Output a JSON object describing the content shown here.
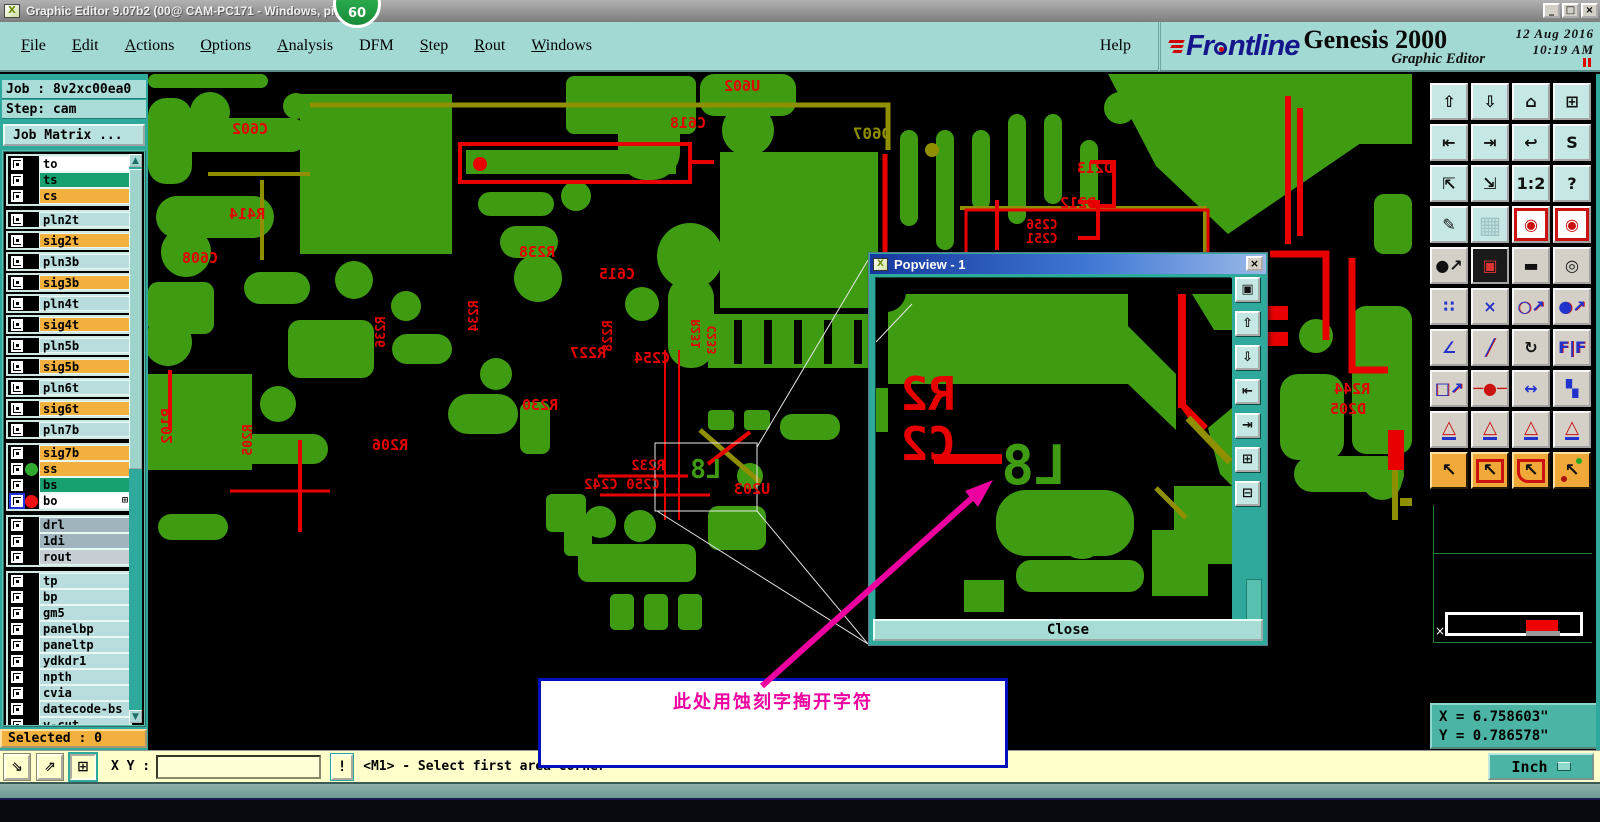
{
  "colors": {
    "red": "#e80000",
    "green": "#3f9b12",
    "olive": "#8f8f00",
    "teal": "#2fa99b",
    "orange": "#f2b13e",
    "magenta": "#ee00a0",
    "popview_blue": "#2858c8"
  },
  "window": {
    "title": "Graphic Editor 9.07b2 (00@   CAM-PC171 - Windows, pid:5572)",
    "badge": "60",
    "minimize": "_",
    "maximize": "□",
    "close": "×",
    "icon_glyph": "X"
  },
  "menu": {
    "items": [
      {
        "label": "File",
        "u": 1
      },
      {
        "label": "Edit",
        "u": 1
      },
      {
        "label": "Actions",
        "u": 1
      },
      {
        "label": "Options",
        "u": 1
      },
      {
        "label": "Analysis",
        "u": 1
      },
      {
        "label": "DFM"
      },
      {
        "label": "Step",
        "u": 1
      },
      {
        "label": "Rout",
        "u": 1
      },
      {
        "label": "Windows",
        "u": 1
      }
    ],
    "help": "Help"
  },
  "brand": {
    "logo_pre": "Fr",
    "logo_post": "ntline",
    "product": "Genesis 2000",
    "date": "12 Aug 2016",
    "time": "10:19 AM",
    "subtitle": "Graphic Editor"
  },
  "sidebar": {
    "job": "Job : 8v2xc00ea0",
    "step": "Step: cam",
    "job_matrix": "Job Matrix ...",
    "selected": "Selected : 0",
    "groups": [
      {
        "style": "tight",
        "rows": [
          {
            "name": "to",
            "bg": "#ffffff"
          },
          {
            "name": "ts",
            "bg": "#18a070"
          },
          {
            "name": "cs",
            "bg": "#f2b13e"
          }
        ]
      },
      {
        "style": "framed",
        "rows": [
          {
            "name": "pln2t",
            "bg": "#b9dcdc"
          },
          {
            "name": "sig2t",
            "bg": "#f2b13e"
          },
          {
            "name": "pln3b",
            "bg": "#b9dcdc"
          },
          {
            "name": "sig3b",
            "bg": "#f2b13e"
          },
          {
            "name": "pln4t",
            "bg": "#b9dcdc"
          },
          {
            "name": "sig4t",
            "bg": "#f2b13e"
          },
          {
            "name": "pln5b",
            "bg": "#b9dcdc"
          },
          {
            "name": "sig5b",
            "bg": "#f2b13e"
          },
          {
            "name": "pln6t",
            "bg": "#b9dcdc"
          },
          {
            "name": "sig6t",
            "bg": "#f2b13e"
          },
          {
            "name": "pln7b",
            "bg": "#b9dcdc"
          }
        ]
      },
      {
        "style": "tight",
        "rows": [
          {
            "name": "sig7b",
            "bg": "#f2b13e"
          },
          {
            "name": "ss",
            "bg": "#f2b13e",
            "dot": "#2faa2f"
          },
          {
            "name": "bs",
            "bg": "#18a070"
          },
          {
            "name": "bo",
            "bg": "#ffffff",
            "dot": "#ee1111",
            "active": true,
            "grid": "⊞"
          }
        ]
      },
      {
        "style": "tight",
        "rows": [
          {
            "name": "drl",
            "bg": "#9fb4bc"
          },
          {
            "name": "1di",
            "bg": "#9fb4bc"
          },
          {
            "name": "rout",
            "bg": "#c6ced4"
          }
        ]
      },
      {
        "style": "tight",
        "rows": [
          {
            "name": "tp",
            "bg": "#b9dcdc"
          },
          {
            "name": "bp",
            "bg": "#b9dcdc"
          },
          {
            "name": "gm5",
            "bg": "#b9dcdc"
          },
          {
            "name": "panelbp",
            "bg": "#b9dcdc"
          },
          {
            "name": "paneltp",
            "bg": "#b9dcdc"
          },
          {
            "name": "ydkdr1",
            "bg": "#b9dcdc"
          },
          {
            "name": "npth",
            "bg": "#b9dcdc"
          },
          {
            "name": "cvia",
            "bg": "#b9dcdc"
          },
          {
            "name": "datecode-bs",
            "bg": "#b9dcdc"
          },
          {
            "name": "v-cut",
            "bg": "#b9dcdc"
          }
        ]
      }
    ]
  },
  "toolbar": {
    "rows": [
      [
        {
          "n": "zoom-in-view-button",
          "g": "⇧",
          "c": "teal"
        },
        {
          "n": "zoom-out-view-button",
          "g": "⇩",
          "c": "teal"
        },
        {
          "n": "home-view-button",
          "g": "⌂",
          "c": "teal"
        },
        {
          "n": "split-view-xy-button",
          "g": "⊞",
          "c": "teal"
        }
      ],
      [
        {
          "n": "pan-left-button",
          "g": "⇤",
          "c": "teal"
        },
        {
          "n": "pan-right-button",
          "g": "⇥",
          "c": "teal"
        },
        {
          "n": "previous-view-button",
          "g": "↩",
          "c": "teal"
        },
        {
          "n": "serpentine-view-button",
          "g": "S",
          "c": "teal"
        }
      ],
      [
        {
          "n": "expand-view-button",
          "g": "⇱",
          "c": "teal"
        },
        {
          "n": "shrink-view-button",
          "g": "⇲",
          "c": "teal"
        },
        {
          "n": "zoom-half-button",
          "g": "1:2",
          "c": "teal"
        },
        {
          "n": "help-pointer-button",
          "g": "?",
          "c": "teal"
        }
      ],
      [
        {
          "n": "editor-tools-button",
          "g": "✎",
          "c": "teal"
        },
        {
          "n": "grid-toggle-button",
          "g": "▦",
          "c": "teal grid"
        },
        {
          "n": "layer-colors-a-button",
          "g": "◉",
          "c": "white redframe gRed"
        },
        {
          "n": "layer-colors-b-button",
          "g": "◉",
          "c": "white redframe gRed"
        }
      ],
      [
        {
          "n": "move-origin-button",
          "g": "●↗",
          "c": "gray"
        },
        {
          "n": "compare-layers-button",
          "g": "▣",
          "c": "gray dark"
        },
        {
          "n": "measure-ruler-button",
          "g": "▬",
          "c": "gray"
        },
        {
          "n": "select-reference-button",
          "g": "◎",
          "c": "gray"
        }
      ],
      [
        {
          "n": "net-highlight-button",
          "g": "∷",
          "c": "gray gBlue"
        },
        {
          "n": "delete-entity-button",
          "g": "×",
          "c": "gray gBlue"
        },
        {
          "n": "measure-point-button",
          "g": "○↗",
          "c": "gray gMix"
        },
        {
          "n": "measure-pad-button",
          "g": "●↗",
          "c": "gray gMix"
        }
      ],
      [
        {
          "n": "measure-angle-button",
          "g": "∠",
          "c": "gray gBlue"
        },
        {
          "n": "measure-slope-button",
          "g": "╱",
          "c": "gray gMix"
        },
        {
          "n": "rotate-entity-button",
          "g": "↻",
          "c": "gray"
        },
        {
          "n": "mirror-entity-button",
          "g": "F|F",
          "c": "gray gMix"
        }
      ],
      [
        {
          "n": "copy-pad-button",
          "g": "□↗",
          "c": "gray gMix"
        },
        {
          "n": "stretch-trace-button",
          "g": "─●─",
          "c": "gray gRed"
        },
        {
          "n": "measure-width-button",
          "g": "↔",
          "c": "gray gBlue"
        },
        {
          "n": "boolean-shapes-button",
          "g": "▚",
          "c": "gray gBlue"
        }
      ],
      [
        {
          "n": "surface-fill-1-button",
          "g": "△",
          "c": "gray tri"
        },
        {
          "n": "surface-fill-2-button",
          "g": "△",
          "c": "gray tri"
        },
        {
          "n": "surface-fill-3-button",
          "g": "△",
          "c": "gray tri"
        },
        {
          "n": "surface-fill-4-button",
          "g": "△",
          "c": "gray tri"
        }
      ],
      [
        {
          "n": "select-pointer-button",
          "g": "↖",
          "c": "orange"
        },
        {
          "n": "select-rectangle-button",
          "g": "↖",
          "c": "orange framebox"
        },
        {
          "n": "select-polygon-button",
          "g": "↖",
          "c": "orange framepoly"
        },
        {
          "n": "select-net-button",
          "g": "↖",
          "c": "orange framedots"
        }
      ]
    ]
  },
  "popview": {
    "title": "Popview - 1",
    "close_button": "Close",
    "close_icon": "×",
    "icon_glyph": "X",
    "buttons": [
      {
        "n": "popview-copy-button",
        "g": "▣"
      },
      {
        "n": "popview-zoom-in-button",
        "g": "⇧"
      },
      {
        "n": "popview-zoom-out-button",
        "g": "⇩"
      },
      {
        "n": "popview-pan-left-button",
        "g": "⇤"
      },
      {
        "n": "popview-pan-right-button",
        "g": "⇥"
      },
      {
        "n": "popview-fit-button",
        "g": "⊞"
      },
      {
        "n": "popview-center-button",
        "g": "⊟"
      }
    ]
  },
  "annotation": {
    "text": "此处用蚀刻字掏开字符"
  },
  "statusbar": {
    "xy_label": "X Y :",
    "xy_value": "",
    "alert": "!",
    "message": "<M1> - Select first area corner",
    "buttons": [
      {
        "n": "corner-select-button",
        "g": "⇘"
      },
      {
        "n": "axis-select-button",
        "g": "⇗"
      },
      {
        "n": "grid-select-button",
        "g": "⊞",
        "c": "pressed"
      }
    ]
  },
  "coords": {
    "x": "X = 6.758603\"",
    "y": "Y = 0.786578\"",
    "units": "Inch"
  },
  "canvas": {
    "labels": [
      {
        "t": "C602",
        "x": 102,
        "y": 60
      },
      {
        "t": "U602",
        "x": 594,
        "y": 17
      },
      {
        "t": "C618",
        "x": 540,
        "y": 54
      },
      {
        "t": "D607",
        "x": 724,
        "y": 65,
        "c": "olive",
        "s": 16
      },
      {
        "t": "D213",
        "x": 947,
        "y": 99
      },
      {
        "t": "D212",
        "x": 930,
        "y": 134
      },
      {
        "t": "C256",
        "x": 894,
        "y": 155,
        "s": 13
      },
      {
        "t": "C251",
        "x": 894,
        "y": 169,
        "s": 13
      },
      {
        "t": "R414",
        "x": 99,
        "y": 145
      },
      {
        "t": "C608",
        "x": 52,
        "y": 189
      },
      {
        "t": "R238",
        "x": 389,
        "y": 183
      },
      {
        "t": "C615",
        "x": 469,
        "y": 205
      },
      {
        "t": "R228",
        "x": 464,
        "y": 262,
        "r": -90,
        "s": 13
      },
      {
        "t": "R234",
        "x": 330,
        "y": 242,
        "r": -90,
        "s": 13
      },
      {
        "t": "R236",
        "x": 237,
        "y": 258,
        "r": -90,
        "s": 13
      },
      {
        "t": "R231",
        "x": 552,
        "y": 260,
        "r": -90,
        "s": 12
      },
      {
        "t": "C233",
        "x": 568,
        "y": 266,
        "r": -90,
        "s": 12
      },
      {
        "t": "R227",
        "x": 440,
        "y": 284
      },
      {
        "t": "C254",
        "x": 504,
        "y": 289
      },
      {
        "t": "R230",
        "x": 392,
        "y": 336
      },
      {
        "t": "P102",
        "x": 24,
        "y": 352,
        "r": -90
      },
      {
        "t": "R205",
        "x": 104,
        "y": 366,
        "r": -90,
        "s": 13
      },
      {
        "t": "R206",
        "x": 242,
        "y": 376
      },
      {
        "t": "R232",
        "x": 500,
        "y": 396,
        "s": 14
      },
      {
        "t": "C250 C242",
        "x": 474,
        "y": 415,
        "s": 14
      },
      {
        "t": "U203",
        "x": 604,
        "y": 420
      },
      {
        "t": "L8",
        "x": 558,
        "y": 404,
        "c": "green",
        "s": 26
      },
      {
        "t": "D207D206",
        "x": 1046,
        "y": 234,
        "s": 13
      },
      {
        "t": "R244",
        "x": 1204,
        "y": 320
      },
      {
        "t": "D205",
        "x": 1200,
        "y": 340
      }
    ],
    "pop_labels": [
      {
        "t": "R2",
        "x": 52,
        "y": 132,
        "s": 46
      },
      {
        "t": "C2",
        "x": 52,
        "y": 182,
        "s": 46
      },
      {
        "t": "L8",
        "x": 158,
        "y": 206,
        "c": "green",
        "s": 54
      }
    ]
  }
}
